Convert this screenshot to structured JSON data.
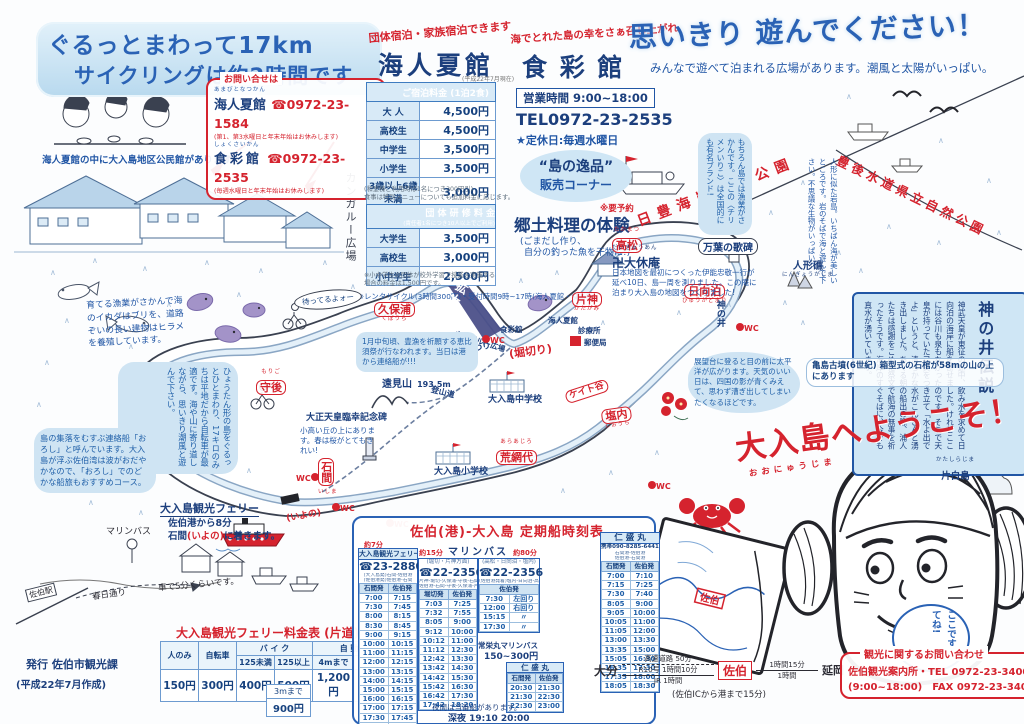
{
  "banner": {
    "line1": "ぐるっとまわって17km",
    "line2": "サイクリングは約2時間です"
  },
  "caption": "海人夏館の中に大入島地区公民館があります",
  "kangaroo_side": "カンガルー広場",
  "inquiry": {
    "title": "お問い合せは",
    "item1_furi": "あまびとなつかん",
    "item1_name": "海人夏館",
    "item1_tel": "☎0972-23-1584",
    "item1_note": "(第1、第3水曜日と年末年始はお休みします)",
    "item2_furi": "しょくさいかん",
    "item2_name": "食彩館",
    "item2_tel": "☎0972-23-2535",
    "item2_note": "(毎週水曜日と年末年始はお休みします)"
  },
  "amabito": {
    "tagline": "団体宿泊・家族宿泊できます",
    "title": "海人夏館",
    "title_note": "(平成22年7月現在)",
    "lodging": {
      "header": "ご宿泊料金 (1泊2食)",
      "rows": [
        [
          "大 人",
          "4,500円"
        ],
        [
          "高校生",
          "4,500円"
        ],
        [
          "中学生",
          "3,500円"
        ],
        [
          "小学生",
          "3,500円"
        ],
        [
          "3歳以上6歳未満",
          "3,000円"
        ]
      ],
      "note1": "(和室棟ご利用時は1名につき300円引)",
      "note2": "食事は特別メニューについても追加料金に応じます。"
    },
    "group": {
      "header": "団 体 研 修 料 金",
      "subheader": "(責任者1名につき10人以上でご利用)",
      "rows": [
        [
          "大学生",
          "3,500円"
        ],
        [
          "高校生",
          "3,000円"
        ],
        [
          "小中学生",
          "2,500円"
        ]
      ],
      "note": "※小中学生の団体が校外学習で授業を実施する場合の料金は1,500円です。"
    },
    "rental_note": "※レンタサイクル(3時間300円)・受付時間9時~17時(海人夏館・食彩館)"
  },
  "shokusai": {
    "tagline": "海でとれた島の幸をさぁ召し上がれ",
    "title": "食 彩 館",
    "hours": "営業時間 9:00~18:00",
    "tel": "TEL0972-23-2535",
    "holiday": "★定休日:毎週水曜日",
    "oval1": "“島の逸品”",
    "oval2": "販売コーナー",
    "reserve": "※要予約",
    "taiken": "郷土料理の体験",
    "note1": "(ごまだし作り、",
    "note2": "自分の釣った魚を干物に!)"
  },
  "headline": {
    "main": "思いきり 遊んでください！",
    "sub": "みんなで遊べて泊まれる広場があります。潮風と太陽がいっぱい。"
  },
  "parks": {
    "coast": "日豊海岸国定公園",
    "bungo": "豊後水道県立自然公園"
  },
  "legend": {
    "title": "神の井伝説",
    "body": "神武天皇が東征の途中、飲み水を求めて日向泊の海岸に船を寄せました。けれどここには谷川も泉もなかったのです。そこで天皇が持っていた弓矢をつき立て「水よ出でよ」というと、清らかな水がこんこんと湧き出しました。あくる朝の船出の際、浦人たちは感謝をこめた祭文で航海の無事を祈ったそうです。海岸のすぐそばに、今でも真水が湧いています。"
  },
  "map": {
    "wc": "WC",
    "places": {
      "takamatsu": {
        "label": "高松",
        "furi": "たかまつ"
      },
      "kubora": {
        "label": "久保浦",
        "furi": "くぼうら"
      },
      "morigo": {
        "label": "守後",
        "furi": "もりご"
      },
      "katagami": {
        "label": "片神",
        "furi": "かたがみ"
      },
      "hyuga": {
        "label": "日向泊",
        "furi": "ひゅうがどまり"
      },
      "horikiri": "(堀切り)",
      "ishima": {
        "label": "石間",
        "furi": "いしま"
      },
      "araajiro": {
        "label": "荒網代",
        "furi": "あらあじろ"
      },
      "keito": "ケイト谷",
      "shiouchi": {
        "label": "塩内",
        "furi": "しおうち"
      }
    },
    "pois": {
      "manyo": "万葉の歌碑",
      "ningyo": {
        "label": "人形礁",
        "furi": "にんぎょうがしま"
      },
      "daikyuan": {
        "label": "卍大休庵",
        "furi": "だいきゅうあん",
        "note": "日本地図を最初につくった伊能忠敬一行が延べ10日、島一周を測りました。この庵に泊まり大入島の地図をつくりました!"
      },
      "kaminoi": "神の井",
      "tomiyama": {
        "label": "遠見山",
        "height": "193.5m"
      },
      "tozando": "登山道",
      "monument": {
        "label": "大正天皇臨幸記念碑",
        "note": "小高い丘の上にあります。春は桜がとてもきれい!"
      },
      "tondo": "トンド火まつり",
      "jhs": "大入島中学校",
      "es": "大入島小学校",
      "shokusaikan": "食彩館",
      "amabito": "海人夏館",
      "clinic": "診療所",
      "post": "郵便局",
      "kakudai": "拡大図",
      "kangaroo": "カンガルー広場",
      "katashira": {
        "label": "片白島",
        "furi": "かたしらじま"
      },
      "kofun": "亀島古墳(6世紀) 箱型式の石棺が58mの山の上にあります"
    },
    "bubbles": {
      "cycle": "ひょうたん形の島をぐるっとひとまわり、17キロのみちは平地だから自転車が最適です。海や山に寄り道しながら、思いきり潮風と遊んで下さい。",
      "oroshi": "島の集落をむすぶ連絡船「おろし」と呼んでいます。大入島が浮ぶ佐伯湾は波がおだやかなので、「おろし」でのどかな船旅もおすすめコース。",
      "yoshoku": "育てる漁業がさかんで海のイカダはブリを、道路ぞいの長い建物はヒラメを養殖しています。",
      "ebisu": "1月中旬頃、豊漁を祈願する恵比須祭が行なわれます。当日は港から連絡船が!!!",
      "tenbo": "展望台に登ると目の前に太平洋が広がります。天気のいい日は、四国の影が青くみえて、思わず漕ぎ出してしまいたくなるほどです。",
      "chirimen": "もちろん島では漁業がさかんです。ここの〈チリメンいりこ〉は全国的にも有名ブランド!",
      "iwaba": "人形に似た岩島。いちばん海が美しいところです。岩のそばで海と遊んで下さい。不思議な生物がいっぱい!",
      "matteru": "待ってるよォー"
    },
    "welcome": {
      "text": "大入島へようこそ！",
      "furi": "おおにゅうじま"
    },
    "koko": "ここです来てね!"
  },
  "port": {
    "title": "大入島観光フェリー",
    "line1": "佐伯港から8分",
    "line2a": "石間",
    "line2b": "(いよの)",
    "line2c": "に着きます。",
    "iyono": "(いよの)",
    "marine_bus": "マリンバス",
    "station": "佐伯駅",
    "kasuga": "春日通り",
    "drive": "車で5分くらいです。"
  },
  "fare": {
    "title": "大入島観光フェリー料金表 (片道)",
    "h_person": "人のみ",
    "h_bicycle": "自転車",
    "h_bike": "バ イ ク",
    "h_bike1": "125未満",
    "h_bike2": "125以上",
    "h_car": "自 動 車",
    "h_car1": "4mまで",
    "h_car2": "5mまで",
    "values": [
      "150円",
      "300円",
      "400円",
      "500円",
      "1,200円",
      "1,600円"
    ],
    "extra_label": "3mまで",
    "extra_value": "900円"
  },
  "timetable": {
    "title": "佐伯(港)-大入島 定期船時刻表",
    "marine": "マリンバス",
    "a": {
      "time_note": "約7分",
      "name": "大入島観光フェリー",
      "tel": "☎23-2880",
      "route1": "(大入島発)石間-佐伯港",
      "route2": "(佐伯港発)佐伯港-石間",
      "col1": "石間発",
      "col2": "佐伯発",
      "rows": [
        [
          "7:00",
          "7:15"
        ],
        [
          "7:30",
          "7:45"
        ],
        [
          "8:00",
          "8:15"
        ],
        [
          "8:30",
          "8:45"
        ],
        [
          "9:00",
          "9:15"
        ],
        [
          "10:00",
          "10:15"
        ],
        [
          "11:00",
          "11:15"
        ],
        [
          "12:00",
          "12:15"
        ],
        [
          "13:00",
          "13:15"
        ],
        [
          "14:00",
          "14:15"
        ],
        [
          "15:00",
          "15:15"
        ],
        [
          "16:00",
          "16:15"
        ],
        [
          "17:00",
          "17:15"
        ],
        [
          "17:30",
          "17:45"
        ],
        [
          "18:00",
          "18:15"
        ]
      ]
    },
    "b": {
      "time_note": "約15分",
      "sub": "(堀切・片神方面)",
      "tel": "☎22-2356",
      "route1": "片神-堀切-久保浦-守後-石間",
      "route2": "佐伯港-石間-守後-久保浦-片神",
      "col1": "堀切発",
      "col2": "佐伯発",
      "rows": [
        [
          "7:03",
          "7:25"
        ],
        [
          "7:32",
          "7:55"
        ],
        [
          "8:05",
          "9:00"
        ],
        [
          "9:12",
          "10:00"
        ],
        [
          "10:12",
          "11:00"
        ],
        [
          "11:12",
          "12:30"
        ],
        [
          "12:42",
          "13:30"
        ],
        [
          "13:42",
          "14:30"
        ],
        [
          "14:42",
          "15:30"
        ],
        [
          "15:42",
          "16:30"
        ],
        [
          "16:42",
          "17:30"
        ],
        [
          "17:42",
          "18:20"
        ]
      ]
    },
    "c": {
      "time_note": "約80分",
      "sub": "(高松・日向泊・塩内)",
      "tel": "☎22-2356",
      "route1": "(佐伯港発着)塩内-日向泊-高松回り",
      "col1": "佐伯発",
      "rows": [
        [
          "7:30",
          "左回り"
        ],
        [
          "12:00",
          "右回り"
        ],
        [
          "15:15",
          "〃"
        ],
        [
          "17:30",
          "〃"
        ]
      ],
      "note1": "常栄丸マリンバス",
      "note2": "150~300円"
    },
    "d": {
      "name": "仁 盛 丸",
      "tel": "携帯090-8285-6441",
      "route1": "石間港-佐伯港",
      "route2": "佐伯港-石間港",
      "col1": "石間発",
      "col2": "佐伯発",
      "rows": [
        [
          "7:00",
          "7:10"
        ],
        [
          "7:15",
          "7:25"
        ],
        [
          "7:30",
          "7:40"
        ],
        [
          "8:05",
          "9:00"
        ],
        [
          "9:05",
          "10:00"
        ],
        [
          "10:05",
          "11:00"
        ],
        [
          "11:05",
          "12:00"
        ],
        [
          "13:00",
          "13:30"
        ],
        [
          "13:35",
          "15:00"
        ],
        [
          "15:05",
          "16:30"
        ],
        [
          "16:35",
          "17:30"
        ],
        [
          "17:35",
          "18:00"
        ],
        [
          "18:05",
          "18:30"
        ]
      ]
    },
    "e": {
      "name": "仁 盛 丸",
      "col1": "石間発",
      "col2": "佐伯発",
      "rows": [
        [
          "20:30",
          "21:30"
        ],
        [
          "21:30",
          "22:30"
        ],
        [
          "22:30",
          "23:00"
        ]
      ]
    },
    "night1": "夜間は当番船があります。",
    "night2": "深夜 19:10 20:00"
  },
  "access": {
    "from": "大分",
    "via_top": "高速道路 50分",
    "via_mid": "R10号 1時間10分",
    "via_bottom": "JR 1時間",
    "hub": "佐伯",
    "seg2_top": "1時間15分",
    "seg2_bottom": "1時間",
    "to": "延岡",
    "note": "(佐伯ICから港まで15分)",
    "map_saiki": "佐伯"
  },
  "contact": {
    "title": "観光に関するお問い合わせ",
    "line1": "佐伯観光案内所・TEL 0972-23-3400",
    "line2": "(9:00~18:00)　FAX 0972-23-3400"
  },
  "publisher": {
    "line1": "発行 佐伯市観光課",
    "line2": "(平成22年7月作成)"
  }
}
